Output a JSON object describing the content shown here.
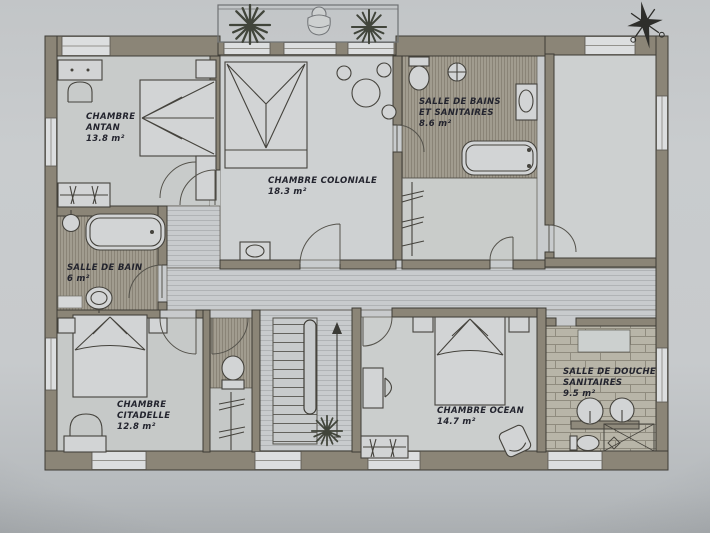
{
  "colors": {
    "paper": "#c6c9cb",
    "wall": "#8b8577",
    "wall_outline": "#3e3c35",
    "ink": "#23242e",
    "floor_light": "#c9cccb",
    "floor_dark_hatch": "#a19c8f",
    "floor_tile": "#b8b5a8"
  },
  "rooms": [
    {
      "id": "chambre-antan",
      "name": "CHAMBRE\nANTAN",
      "area": "13.8 m²"
    },
    {
      "id": "chambre-coloniale",
      "name": "CHAMBRE COLONIALE",
      "area": "18.3 m²"
    },
    {
      "id": "salle-de-bains-et-sanitaires",
      "name": "SALLE DE BAINS\nET SANITAIRES",
      "area": "8.6 m²"
    },
    {
      "id": "salle-de-bain",
      "name": "SALLE DE BAIN",
      "area": "6 m²"
    },
    {
      "id": "chambre-citadelle",
      "name": "CHAMBRE\nCITADELLE",
      "area": "12.8 m²"
    },
    {
      "id": "chambre-ocean",
      "name": "CHAMBRE OCEAN",
      "area": "14.7 m²"
    },
    {
      "id": "salle-de-douche-sanitaires",
      "name": "SALLE DE DOUCHE\nSANITAIRES",
      "area": "9.5 m²"
    }
  ],
  "decorations": {
    "compass": "compass-rose-icon",
    "plants": "plant-icon",
    "stairs_direction": "up-arrow-icon",
    "balcony_furniture": "sun-lounger-icon"
  }
}
